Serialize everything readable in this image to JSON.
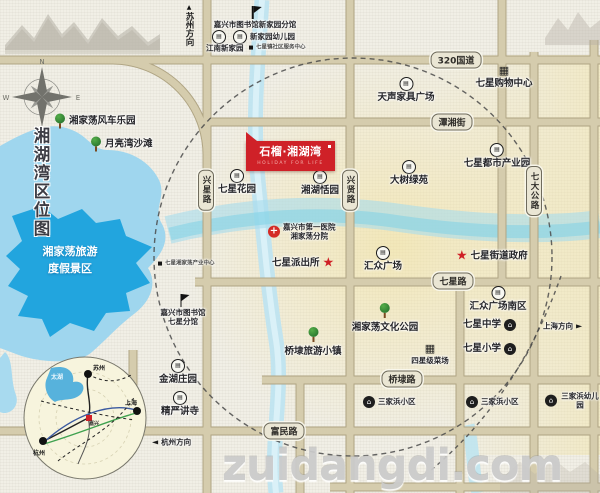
{
  "page": {
    "title_vertical": "湘湖湾区位图",
    "watermark": "zuidangdi.com"
  },
  "banner": {
    "title": "石榴·湘湖湾",
    "tagline": "HOLIDAY FOR LIFE"
  },
  "lake": {
    "name": "湘家荡旅游\n度假景区"
  },
  "directions": {
    "north": "苏州方向",
    "east": "上海方向",
    "west": "杭州方向"
  },
  "colors": {
    "accent_red": "#cf2128",
    "road_fill": "#d5ccad",
    "road_casing": "#b0a584",
    "river": "#bfe4f0",
    "lake_outer": "#9fd6ee",
    "lake_inner": "#22a5de",
    "paper": "#f1efe6",
    "watermark": "#cbcbcb"
  },
  "road_labels": [
    {
      "text": "320国道",
      "x": 456,
      "y": 60,
      "o": "h"
    },
    {
      "text": "潭湘街",
      "x": 452,
      "y": 122,
      "o": "h"
    },
    {
      "text": "七星路",
      "x": 453,
      "y": 281,
      "o": "h"
    },
    {
      "text": "桥埭路",
      "x": 402,
      "y": 379,
      "o": "h"
    },
    {
      "text": "富民路",
      "x": 284,
      "y": 431,
      "o": "h"
    },
    {
      "text": "兴星路",
      "x": 206,
      "y": 190,
      "o": "v"
    },
    {
      "text": "兴贤路",
      "x": 350,
      "y": 190,
      "o": "v"
    },
    {
      "text": "七大公路",
      "x": 534,
      "y": 191,
      "o": "v"
    }
  ],
  "pois": [
    {
      "x": 255,
      "y": 6,
      "icon": "flag",
      "label": "嘉兴市图书馆新家园分馆",
      "layout": "col",
      "size": "s"
    },
    {
      "x": 212,
      "y": 37,
      "icon": "circle",
      "label": "",
      "layout": "row",
      "size": "s"
    },
    {
      "x": 233,
      "y": 37,
      "icon": "circle",
      "label": "新家园幼儿园",
      "layout": "row",
      "size": "s"
    },
    {
      "x": 206,
      "y": 48,
      "icon": "none",
      "label": "江南新家园",
      "layout": "row",
      "size": "s"
    },
    {
      "x": 249,
      "y": 48,
      "icon": "dot",
      "label": "七星镇社区服务中心",
      "layout": "row",
      "size": "xs"
    },
    {
      "x": 406,
      "y": 77,
      "icon": "circle",
      "label": "天声家具广场",
      "layout": "col",
      "size": "m"
    },
    {
      "x": 504,
      "y": 64,
      "icon": "cart",
      "label": "七星购物中心",
      "layout": "col",
      "size": "m"
    },
    {
      "x": 497,
      "y": 143,
      "icon": "circle",
      "label": "七星都市产业园",
      "layout": "col",
      "size": "m"
    },
    {
      "x": 409,
      "y": 160,
      "icon": "circle",
      "label": "大树绿苑",
      "layout": "col",
      "size": "m"
    },
    {
      "x": 320,
      "y": 170,
      "icon": "circle",
      "label": "湘湖恬园",
      "layout": "col",
      "size": "m"
    },
    {
      "x": 237,
      "y": 169,
      "icon": "circle",
      "label": "七星花园",
      "layout": "col",
      "size": "m"
    },
    {
      "x": 268,
      "y": 232,
      "icon": "cross",
      "label": "嘉兴市第一医院\n湘家荡分院",
      "layout": "hospital",
      "size": "s"
    },
    {
      "x": 272,
      "y": 263,
      "icon": "star",
      "label": "七星派出所",
      "layout": "row-rev",
      "size": "m"
    },
    {
      "x": 383,
      "y": 246,
      "icon": "circle",
      "label": "汇众广场",
      "layout": "col",
      "size": "m"
    },
    {
      "x": 456,
      "y": 256,
      "icon": "star",
      "label": "七星街道政府",
      "layout": "row",
      "size": "m"
    },
    {
      "x": 385,
      "y": 303,
      "icon": "tree",
      "label": "湘家荡文化公园",
      "layout": "col2",
      "size": "m"
    },
    {
      "x": 313,
      "y": 327,
      "icon": "tree",
      "label": "桥埭旅游小镇",
      "layout": "col2",
      "size": "m"
    },
    {
      "x": 430,
      "y": 342,
      "icon": "cart",
      "label": "四星级菜场",
      "layout": "col",
      "size": "s"
    },
    {
      "x": 498,
      "y": 286,
      "icon": "circle",
      "label": "汇众广场南区",
      "layout": "col",
      "size": "m"
    },
    {
      "x": 463,
      "y": 325,
      "icon": "school",
      "label": "七星中学",
      "layout": "row-rev",
      "size": "m"
    },
    {
      "x": 463,
      "y": 349,
      "icon": "school",
      "label": "七星小学",
      "layout": "row-rev",
      "size": "m"
    },
    {
      "x": 543,
      "y": 326,
      "icon": "none",
      "label": "上海方向",
      "layout": "dir-right",
      "size": "s"
    },
    {
      "x": 363,
      "y": 402,
      "icon": "school",
      "label": "三家浜小区",
      "layout": "row",
      "size": "s"
    },
    {
      "x": 466,
      "y": 402,
      "icon": "school",
      "label": "三家浜小区",
      "layout": "row",
      "size": "s"
    },
    {
      "x": 545,
      "y": 401,
      "icon": "school",
      "label": "三家浜幼儿园",
      "layout": "row",
      "size": "s"
    },
    {
      "x": 178,
      "y": 359,
      "icon": "circle",
      "label": "金湖庄园",
      "layout": "col",
      "size": "m"
    },
    {
      "x": 180,
      "y": 391,
      "icon": "circle",
      "label": "精严讲寺",
      "layout": "col",
      "size": "m"
    },
    {
      "x": 152,
      "y": 442,
      "icon": "none",
      "label": "杭州方向",
      "layout": "dir-left",
      "size": "s"
    },
    {
      "x": 54,
      "y": 121,
      "icon": "tree",
      "label": "湘家荡风车乐园",
      "layout": "row",
      "size": "m"
    },
    {
      "x": 90,
      "y": 144,
      "icon": "tree",
      "label": "月亮湾沙滩",
      "layout": "row",
      "size": "m"
    },
    {
      "x": 183,
      "y": 294,
      "icon": "flag",
      "label": "嘉兴市图书馆\n七星分馆",
      "layout": "col",
      "size": "s"
    },
    {
      "x": 158,
      "y": 264,
      "icon": "dot",
      "label": "七星湘家荡产业中心",
      "layout": "row",
      "size": "xs"
    }
  ],
  "inset": {
    "lake_label": "太湖",
    "center_label": "嘉兴",
    "cities": [
      {
        "name": "苏州",
        "x": 70,
        "y": 7,
        "dotx": 65,
        "doty": 18
      },
      {
        "name": "上海",
        "x": 102,
        "y": 42,
        "dotx": 114,
        "doty": 55
      },
      {
        "name": "杭州",
        "x": 10,
        "y": 92,
        "dotx": 20,
        "doty": 85
      }
    ]
  }
}
